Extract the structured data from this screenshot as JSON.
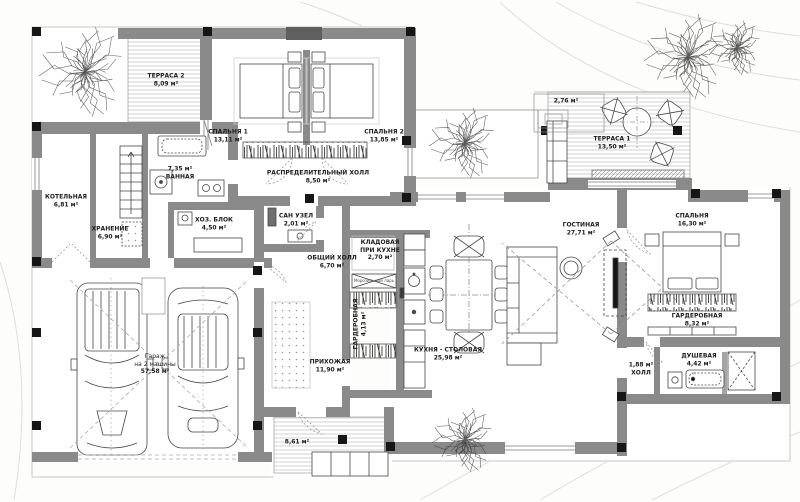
{
  "drawing": {
    "type": "architectural-floor-plan",
    "language": "ru",
    "units": "м²"
  },
  "colors": {
    "wall": "#8a8a8a",
    "wall_dark": "#5f5f5f",
    "column": "#161616",
    "furniture_line": "#474747",
    "deck_hatch": "#bdbdbd",
    "contour": "#dedede",
    "label_text": "#1d1d1d"
  },
  "rooms": [
    {
      "name": "ТЕРРАСА 2",
      "area": "8,09 м²"
    },
    {
      "name": "СПАЛЬНЯ 1",
      "area": "13,11 м²"
    },
    {
      "name": "СПАЛЬНЯ 2",
      "area": "13,85 м²"
    },
    {
      "name": "7,35 м²",
      "area": "ВАННАЯ"
    },
    {
      "name": "РАСПРЕДЕЛИТЕЛЬНЫЙ ХОЛЛ",
      "area": "8,50 м²"
    },
    {
      "name": "КОТЕЛЬНАЯ",
      "area": "6,81 м²"
    },
    {
      "name": "ХРАНЕНИЕ",
      "area": "6,90 м²"
    },
    {
      "name": "ХОЗ. БЛОК",
      "area": "4,50 м²"
    },
    {
      "name": "САН УЗЕЛ",
      "area": "2,01 м²"
    },
    {
      "name": "ОБЩИЙ ХОЛЛ",
      "area": "6,70 м²"
    },
    {
      "name": "КЛАДОВАЯ\nПРИ КУХНЕ",
      "area": "2,70 м²"
    },
    {
      "name": "Морозильный ларь",
      "area": ""
    },
    {
      "name": "ГАРДЕРОБНАЯ",
      "area": "4,13 м²"
    },
    {
      "name": "ПРИХОЖАЯ",
      "area": "11,90 м²"
    },
    {
      "name": "КУХНЯ - СТОЛОВАЯ",
      "area": "25,98 м²"
    },
    {
      "name": "ГОСТИНАЯ",
      "area": "27,71 м²"
    },
    {
      "name": "СПАЛЬНЯ",
      "area": "16,30 м²"
    },
    {
      "name": "ГАРДЕРОБНАЯ",
      "area": "8,32 м²"
    },
    {
      "name": "ДУШЕВАЯ",
      "area": "4,42 м²"
    },
    {
      "name": "1,88 м²",
      "area": "ХОЛЛ"
    },
    {
      "name": "ТЕРРАСА 1",
      "area": "13,50 м²"
    },
    {
      "name": "2,76 м²",
      "area": ""
    },
    {
      "name": "Гараж\nна 2 машины",
      "area": "57,58 м²"
    },
    {
      "name": "8,61 м²",
      "area": ""
    }
  ]
}
